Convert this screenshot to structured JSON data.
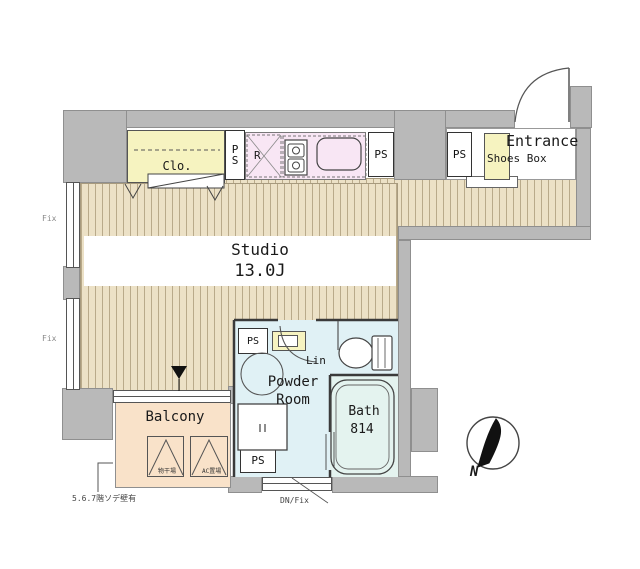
{
  "rooms": {
    "studio": {
      "label": "Studio",
      "area": "13.0J"
    },
    "closet": {
      "label": "Clo."
    },
    "kitchen": {
      "fridge_label": "R"
    },
    "entrance": {
      "label": "Entrance"
    },
    "shoes_box": {
      "label": "Shoes Box"
    },
    "powder_room": {
      "label_line1": "Powder",
      "label_line2": "Room"
    },
    "linen": {
      "label": "Lin"
    },
    "bath": {
      "label": "Bath",
      "size": "814"
    },
    "balcony": {
      "label": "Balcony",
      "left_box_label": "物干場",
      "right_box_label": "AC置場"
    }
  },
  "labels": {
    "ps": "PS",
    "ps_vertical_p": "P",
    "ps_vertical_s": "S",
    "fix_upper": "Fix",
    "fix_lower": "Fix",
    "dn_fix": "DN/Fix",
    "wall_note": "5.6.7階ソデ壁有",
    "north": "N"
  },
  "colors": {
    "wall_gray": "#b9b9b9",
    "flooring_base": "#ece1c6",
    "flooring_stripe": "#b9aa8a",
    "closet_yellow": "#f6f3c0",
    "kitchen_pink": "#f8e6f4",
    "wet_area_cyan": "#e0f1f5",
    "bath_cyan": "#e4f3ef",
    "balcony_peach": "#f9e2c9"
  }
}
